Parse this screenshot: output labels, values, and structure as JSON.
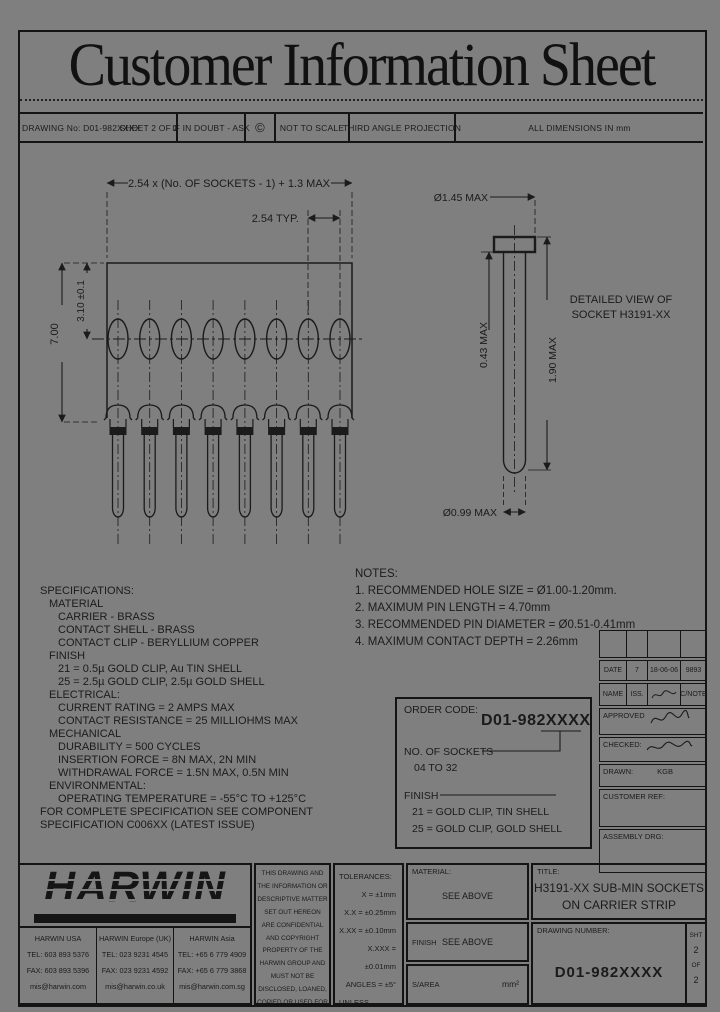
{
  "sheet_title": "Customer Information Sheet",
  "header": {
    "drawing_no": "DRAWING No: D01-982XXXX",
    "sheet": "SHEET 2 OF 2",
    "doubt": "IF IN DOUBT - ASK",
    "copyright": "©",
    "scale": "NOT TO SCALE",
    "projection": "THIRD ANGLE PROJECTION",
    "units": "ALL DIMENSIONS IN mm"
  },
  "drawing": {
    "dim_overall": "2.54 x (No. OF SOCKETS - 1) + 1.3 MAX",
    "dim_pitch": "2.54 TYP.",
    "dim_height": "7.00",
    "dim_depth": "3.10 ±0.1",
    "detail_dia_top": "Ø1.45 MAX",
    "detail_thickness": "0.43 MAX",
    "detail_length": "1.90 MAX",
    "detail_dia_bottom": "Ø0.99 MAX",
    "detail_caption_1": "DETAILED VIEW OF",
    "detail_caption_2": "SOCKET H3191-XX"
  },
  "notes": {
    "title": "NOTES:",
    "item_1": "1. RECOMMENDED HOLE SIZE = Ø1.00-1.20mm.",
    "item_2": "2. MAXIMUM PIN LENGTH = 4.70mm",
    "item_3": "3. RECOMMENDED PIN DIAMETER = Ø0.51-0.41mm",
    "item_4": "4. MAXIMUM CONTACT DEPTH = 2.26mm"
  },
  "specs": {
    "lines": [
      "SPECIFICATIONS:",
      "MATERIAL",
      "CARRIER - BRASS",
      "CONTACT SHELL - BRASS",
      "CONTACT CLIP - BERYLLIUM COPPER",
      "FINISH",
      "21 = 0.5µ GOLD CLIP, Au TIN SHELL",
      "25 = 2.5µ GOLD CLIP, 2.5µ GOLD SHELL",
      "ELECTRICAL:",
      "CURRENT RATING = 2 AMPS MAX",
      "CONTACT RESISTANCE = 25 MILLIOHMS MAX",
      "MECHANICAL",
      "DURABILITY = 500 CYCLES",
      "INSERTION FORCE = 8N MAX, 2N MIN",
      "WITHDRAWAL FORCE = 1.5N MAX, 0.5N MIN",
      "ENVIRONMENTAL:",
      "OPERATING TEMPERATURE = -55°C TO +125°C",
      "FOR COMPLETE SPECIFICATION SEE COMPONENT",
      "SPECIFICATION C006XX (LATEST ISSUE)"
    ]
  },
  "order": {
    "label": "ORDER CODE:",
    "code": "D01-982XXXX",
    "sockets_label": "NO. OF SOCKETS",
    "sockets_range": "04 TO 32",
    "finish_label": "FINISH",
    "finish_1": "21 = GOLD CLIP, TIN SHELL",
    "finish_2": "25 = GOLD CLIP, GOLD SHELL"
  },
  "rev": {
    "date_label": "DATE",
    "date_iss": "7",
    "date_value": "18-06-06",
    "date_note": "9893",
    "name_label": "NAME",
    "iss_label": "ISS.",
    "cnote_label": "C/NOTE",
    "approved_label": "APPROVED",
    "checked_label": "CHECKED:",
    "drawn_label": "DRAWN:",
    "drawn_by": "KGB",
    "customer_ref": "CUSTOMER REF:",
    "assembly": "ASSEMBLY DRG:"
  },
  "footer": {
    "logo": "HARWIN",
    "offices": [
      {
        "name": "HARWIN USA",
        "tel": "TEL: 603 893 5376",
        "fax": "FAX: 603 893 5396",
        "email": "mis@harwin.com"
      },
      {
        "name": "HARWIN Europe (UK)",
        "tel": "TEL: 023 9231 4545",
        "fax": "FAX: 023 9231 4592",
        "email": "mis@harwin.co.uk"
      },
      {
        "name": "HARWIN Asia",
        "tel": "TEL: +65 6 779 4909",
        "fax": "FAX: +65 6 779 3868",
        "email": "mis@harwin.com.sg"
      }
    ],
    "disclaimer": "THIS DRAWING AND THE INFORMATION OR DESCRIPTIVE MATTER SET OUT HEREON ARE CONFIDENTIAL AND COPYRIGHT PROPERTY OF THE HARWIN GROUP AND MUST NOT BE DISCLOSED, LOANED, COPIED OR USED FOR MANUFACTURING, TENDERING OR FOR ANY OTHER PURPOSE WITHOUT THEIR WRITTEN PERMISSION.",
    "tol_title": "TOLERANCES:",
    "tol_1": "X = ±1mm",
    "tol_2": "X.X = ±0.25mm",
    "tol_3": "X.XX = ±0.10mm",
    "tol_4": "X.XXX = ±0.01mm",
    "tol_5": "ANGLES = ±5°",
    "tol_6": "UNLESS STATED",
    "material_label": "MATERIAL:",
    "material_value": "SEE ABOVE",
    "finish_label": "FINISH",
    "finish_value": "SEE ABOVE",
    "sarea_label": "S/AREA",
    "sarea_value": "mm²",
    "title_label": "TITLE:",
    "title_line1": "H3191-XX SUB-MIN SOCKETS",
    "title_line2": "ON CARRIER STRIP",
    "dn_label": "DRAWING NUMBER:",
    "dn_value": "D01-982XXXX",
    "sht_label": "SHT",
    "sht_no": "2",
    "sht_of": "OF",
    "sht_total": "2"
  }
}
